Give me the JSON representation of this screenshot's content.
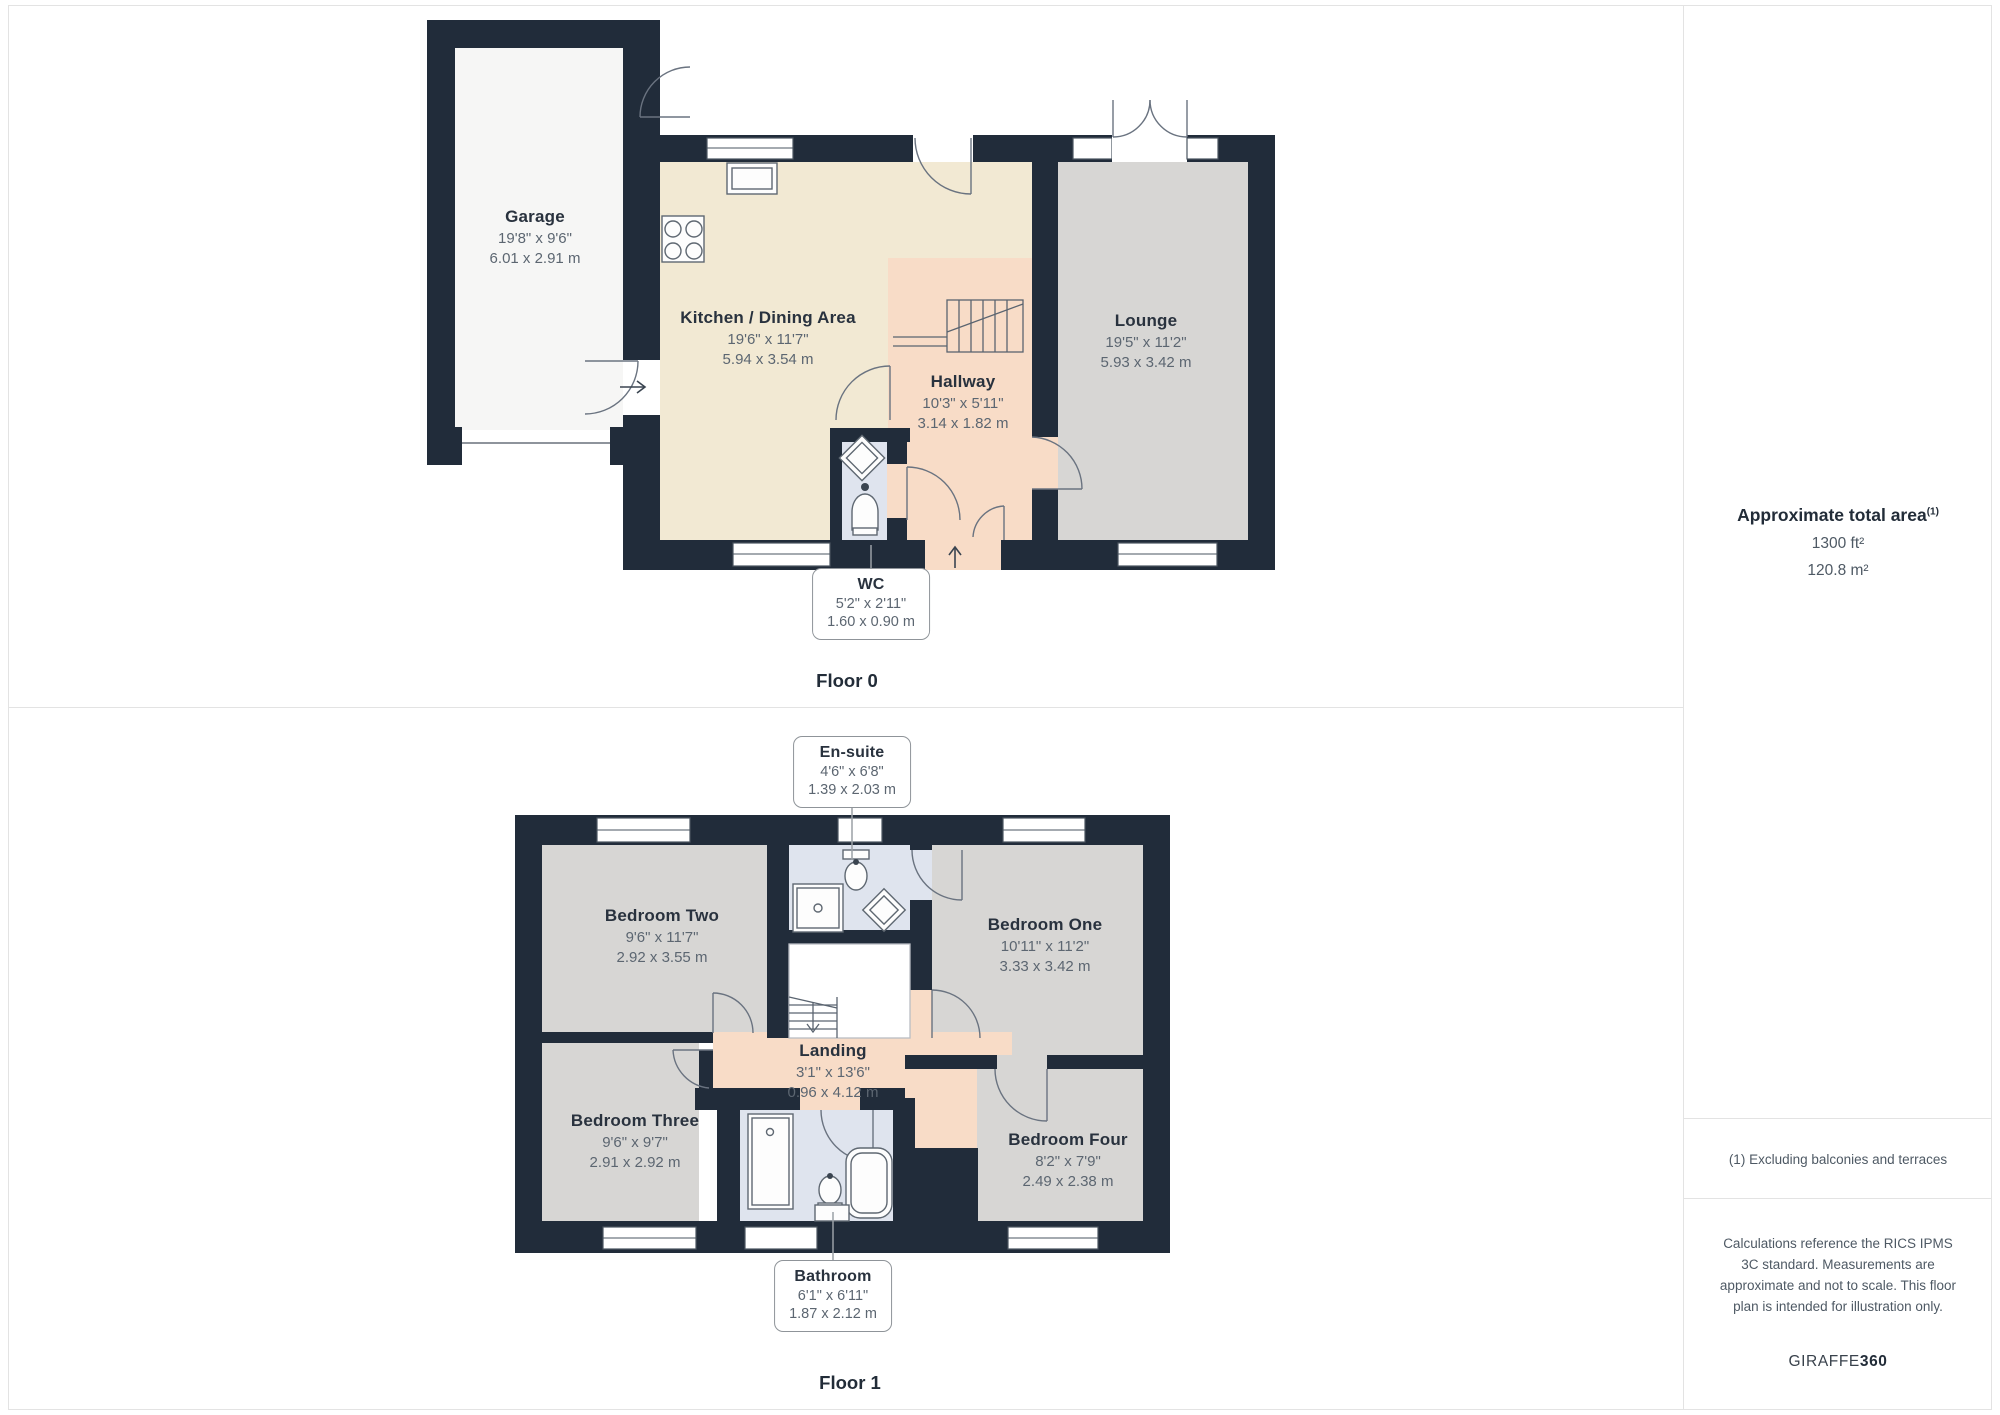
{
  "panel": {
    "title": "Approximate total area",
    "title_sup": "(1)",
    "area_ft": "1300 ft²",
    "area_m": "120.8 m²",
    "footnote": "(1) Excluding balconies and terraces",
    "disclaimer": "Calculations reference the RICS IPMS 3C standard. Measurements are approximate and not to scale. This floor plan is intended for illustration only.",
    "brand_name": "GIRAFFE",
    "brand_bold": "360"
  },
  "floor0": {
    "label": "Floor 0",
    "rooms": {
      "garage": {
        "name": "Garage",
        "imperial": "19'8\" x 9'6\"",
        "metric": "6.01 x 2.91 m"
      },
      "kitchen": {
        "name": "Kitchen / Dining Area",
        "imperial": "19'6\" x 11'7\"",
        "metric": "5.94 x 3.54 m"
      },
      "hallway": {
        "name": "Hallway",
        "imperial": "10'3\" x 5'11\"",
        "metric": "3.14 x 1.82 m"
      },
      "lounge": {
        "name": "Lounge",
        "imperial": "19'5\" x 11'2\"",
        "metric": "5.93 x 3.42 m"
      },
      "wc": {
        "name": "WC",
        "imperial": "5'2\" x 2'11\"",
        "metric": "1.60 x 0.90 m"
      }
    }
  },
  "floor1": {
    "label": "Floor 1",
    "rooms": {
      "ensuite": {
        "name": "En-suite",
        "imperial": "4'6\" x 6'8\"",
        "metric": "1.39 x 2.03 m"
      },
      "bedroom_two": {
        "name": "Bedroom Two",
        "imperial": "9'6\" x 11'7\"",
        "metric": "2.92 x 3.55 m"
      },
      "bedroom_one": {
        "name": "Bedroom One",
        "imperial": "10'11\" x 11'2\"",
        "metric": "3.33 x 3.42 m"
      },
      "bedroom_three": {
        "name": "Bedroom Three",
        "imperial": "9'6\" x 9'7\"",
        "metric": "2.91 x 2.92 m"
      },
      "bedroom_four": {
        "name": "Bedroom Four",
        "imperial": "8'2\" x 7'9\"",
        "metric": "2.49 x 2.38 m"
      },
      "landing": {
        "name": "Landing",
        "imperial": "3'1\" x 13'6\"",
        "metric": "0.96 x 4.12 m"
      },
      "bathroom": {
        "name": "Bathroom",
        "imperial": "6'1\" x 6'11\"",
        "metric": "1.87 x 2.12 m"
      }
    }
  },
  "colors": {
    "wall": "#212c3a",
    "room_gray": "#d7d6d4",
    "room_cream": "#f2e9d3",
    "room_pink": "#f8dcc7",
    "room_blue": "#dfe4ee",
    "room_white": "#f6f6f5"
  }
}
